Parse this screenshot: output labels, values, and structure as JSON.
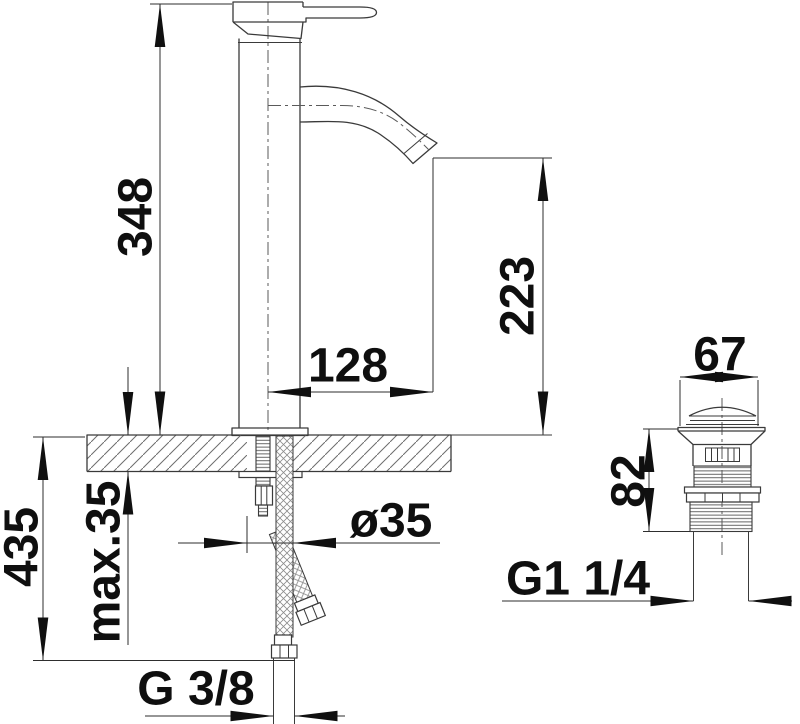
{
  "drawing": {
    "type": "technical dimension drawing",
    "subject": "single-lever basin mixer tap with flexible supply hoses and pop-up drain valve",
    "background_color": "#ffffff",
    "line_color": "#3a3a3a",
    "text_color": "#0f0f0f",
    "dimensions": {
      "faucet_total_height": "348",
      "spout_outlet_height": "223",
      "spout_reach": "128",
      "mounting_hole_diameter": "ø35",
      "max_mounting_thickness": "max.35",
      "overall_height_with_hoses": "435",
      "supply_hose_thread": "G 3/8",
      "drain_cap_width": "67",
      "drain_body_height": "82",
      "drain_thread": "G1 1/4"
    }
  }
}
